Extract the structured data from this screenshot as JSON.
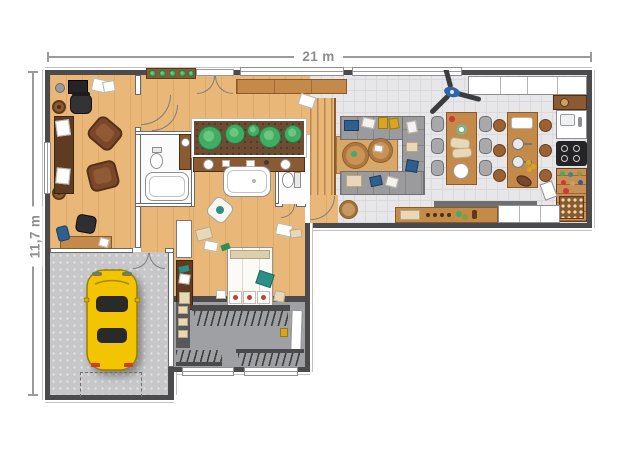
{
  "dimension_labels": {
    "top": "21 m",
    "left": "11,7 m"
  },
  "palette": {
    "wall": "#4b4b4d",
    "wall_trim": "#c2c2c3",
    "dim_line": "#9b9b9b",
    "dim_text": "#8d8d8d",
    "wood": "#e9b778",
    "furniture_wood": "#c48a4a",
    "dark_table": "#5f3b22",
    "soil": "#6e4b33",
    "plant": "#3fae62",
    "plant_dark": "#257a44",
    "tile": "#e7e7e9",
    "tile_line": "#dadadd",
    "garage_floor": "#c7c7c9",
    "closet_floor": "#9ea0a3",
    "sofa_gray": "#9b9b9e",
    "chair_gray": "#a9a9ab",
    "car_yellow": "#f2c500",
    "accent_blue": "#2e5f8e",
    "accent_mustard": "#d8a520",
    "accent_red": "#cc3a33",
    "accent_teal": "#2e8f86"
  }
}
